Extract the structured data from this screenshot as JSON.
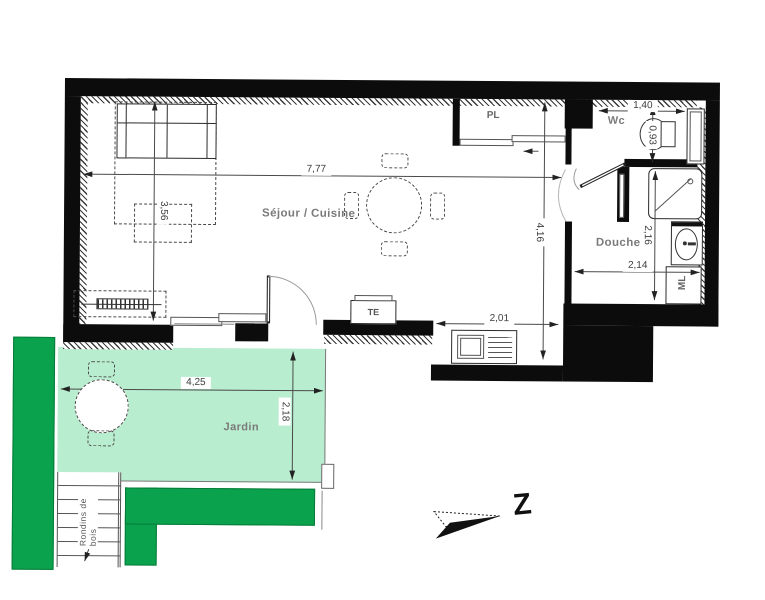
{
  "plan": {
    "rooms": {
      "sejour": {
        "label": "Séjour / Cuisine"
      },
      "wc": {
        "label": "Wc"
      },
      "douche": {
        "label": "Douche"
      },
      "jardin": {
        "label": "Jardin"
      },
      "placard": {
        "label": "PL"
      },
      "electrical_panel": {
        "label": "TE"
      },
      "washing_machine": {
        "label": "ML"
      },
      "wood_logs": {
        "label": "Rondins de bois"
      }
    },
    "dimensions": {
      "sejour_width": {
        "value": "7,77"
      },
      "sejour_depth": {
        "value": "3,56"
      },
      "plan_depth": {
        "value": "4,16"
      },
      "wc_width": {
        "value": "1,40"
      },
      "wc_depth": {
        "value": "0,93"
      },
      "douche_depth": {
        "value": "2,16"
      },
      "douche_width": {
        "value": "2,14"
      },
      "kitchen_width": {
        "value": "2,01"
      },
      "jardin_width": {
        "value": "4,25"
      },
      "jardin_depth": {
        "value": "2,18"
      }
    },
    "compass": {
      "label": "Z"
    },
    "colors": {
      "jardin_fill": "#b9edcf",
      "hedge_fill": "#0ba24d",
      "wall": "#0c0c0c"
    }
  }
}
